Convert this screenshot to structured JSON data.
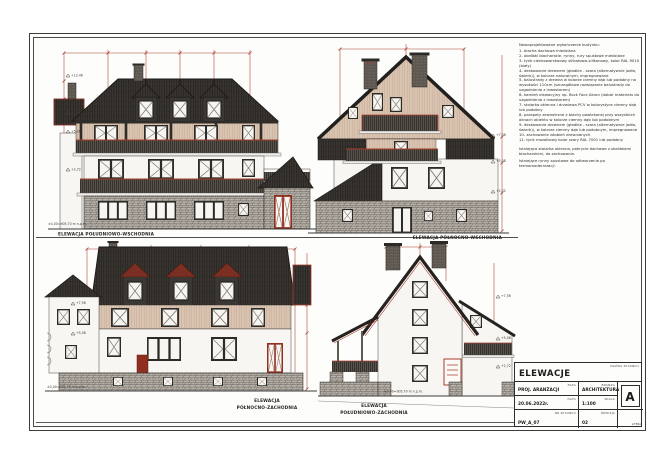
{
  "notes": {
    "title": "Nowoprojektowane wykończenie budynku:",
    "items": [
      "1- blacha dachowa miedziana",
      "2- obróbki blacharskie, rynny, rury spustowe miedziane",
      "3- tynk cienkowarstwowy silikatowo-silikonowy, kolor RAL 9010 (biały)",
      "4- deskowanie drewnem (gładkie - szara (alternatywnie jodła, świerk)), w kolorze naturalnym, impregnowane",
      "5- balustrady z drewna w kolorze ciemny dąb lub podobny na wysokości 110cm (szczegółowe rozwiązanie balustrady do uzgodnienia z inwestorem)",
      "6- kamień elewacyjny np. Rock Face Akron (dobór materiału do uzgodnienia z inwestorem)",
      "7- stolarka okienna i drzwiowa PCV w kolorystyce ciemny dąb lub podobny",
      "8- parapety zewnętrzne z blachy powlekanej przy wszystkich oknach obiektu w kolorze ciemny dąb lub podobnym",
      "9- deskowanie drewnem (gładkie - szara (alternatywnie jodła, świerk)), w kolorze ciemny dąb lub podobnym, impregnowane",
      "10- zachowanie zdobień drewnianych",
      "11- tynk mozaikowy kolor szary RAL 7001 lub podobny"
    ],
    "footer": [
      "Istniejąca stolarka okienna, pokrycie dachowe z obróbkami blacharskimi, do zachowania.",
      "Istniejące rynny spustowe do odtworzenia po termomodernizacji."
    ]
  },
  "elevations": {
    "se": {
      "label": "ELEWACJA POŁUDNIOWO-WSCHODNIA"
    },
    "ne": {
      "label": "ELEWACJA PÓŁNOCNO-WSCHODNIA"
    },
    "nw": {
      "line1": "ELEWACJA",
      "line2": "PÓŁNOCNO-ZACHODNIA"
    },
    "sw": {
      "line1": "ELEWACJA",
      "line2": "POŁUDNIOWO-ZACHODNIA"
    }
  },
  "levels": {
    "ridge": "+12,46",
    "eaves": "+7,56",
    "balcony": "+5,08",
    "floor": "+2,72",
    "ground_full": "±0,00=905,70 m n.p.m."
  },
  "title_block": {
    "drawing_name_label": "NAZWA RYSUNKU",
    "drawing_name": "ELEWACJE",
    "phase_label": "FAZA",
    "phase": "PROJ. ARANŻACJI",
    "discipline_label": "BRANŻA",
    "discipline": "ARCHITEKTURA",
    "date_label": "DATA",
    "date": "20.06.2022r.",
    "scale_label": "SKALA",
    "scale": "1:100",
    "number_label": "NR RYSUNKU",
    "number": "PW_A_07",
    "revision_label": "REWIZJA",
    "revision": "02",
    "letter": "A",
    "letter_label": "LITERA"
  },
  "colors": {
    "dimension_red": "#a83d2c",
    "roof_dark": "#3a3632",
    "wood_beige": "#d9c3b1",
    "stone_gray": "#b7b2aa",
    "door_red": "#8f2f20"
  }
}
